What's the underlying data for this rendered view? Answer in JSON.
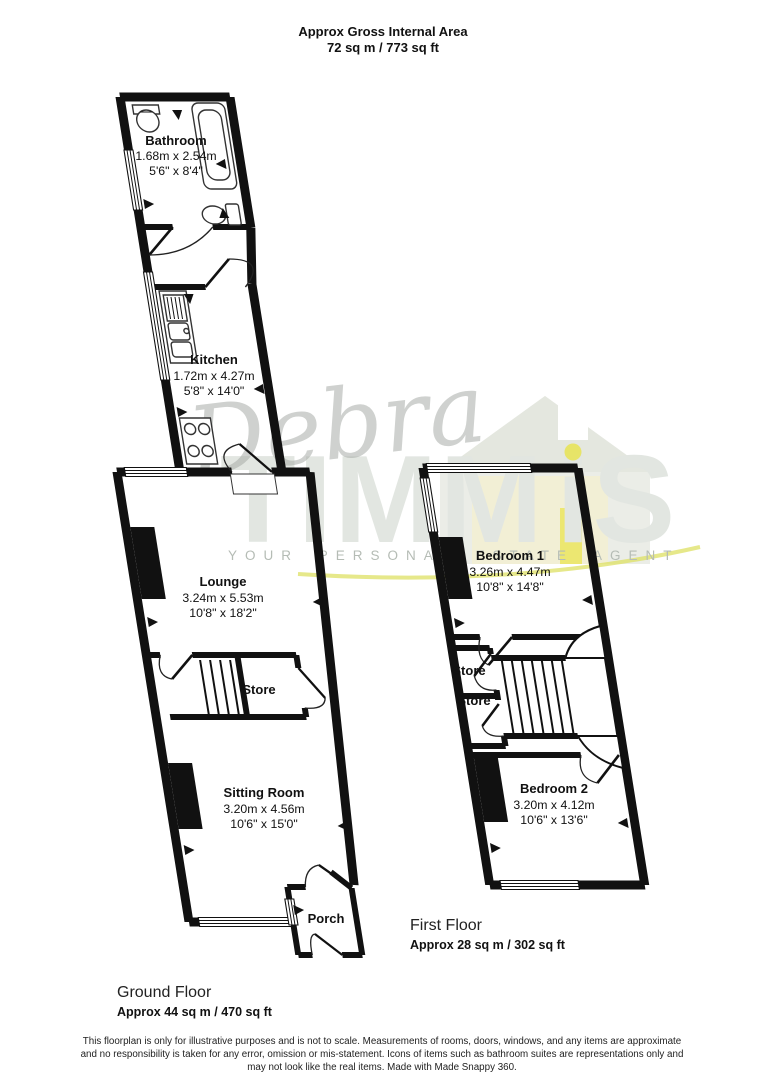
{
  "header": {
    "title_line1": "Approx Gross Internal Area",
    "title_line2": "72 sq m / 773 sq ft"
  },
  "watermark": {
    "script": "Debra",
    "brand_part1": "TIMM",
    "brand_part2": "iS",
    "tagline": "YOUR PERSONAL ESTATE AGENT",
    "colors": {
      "brand_gray": "#e2e6e1",
      "tagline_gray": "#b5bcb5",
      "accent_yellow": "#e8e352",
      "swoosh_yellow": "#dde063"
    }
  },
  "ground_floor": {
    "label": "Ground Floor",
    "area": "Approx 44 sq m / 470 sq ft",
    "rooms": {
      "bathroom": {
        "name": "Bathroom",
        "dims_m": "1.68m x 2.54m",
        "dims_ft": "5'6\" x 8'4\""
      },
      "kitchen": {
        "name": "Kitchen",
        "dims_m": "1.72m x 4.27m",
        "dims_ft": "5'8\" x 14'0\""
      },
      "lounge": {
        "name": "Lounge",
        "dims_m": "3.24m x 5.53m",
        "dims_ft": "10'8\" x 18'2\""
      },
      "store": {
        "name": "Store"
      },
      "sitting_room": {
        "name": "Sitting Room",
        "dims_m": "3.20m x 4.56m",
        "dims_ft": "10'6\" x 15'0\""
      },
      "porch": {
        "name": "Porch"
      }
    }
  },
  "first_floor": {
    "label": "First Floor",
    "area": "Approx 28 sq m / 302 sq ft",
    "rooms": {
      "bedroom1": {
        "name": "Bedroom 1",
        "dims_m": "3.26m x 4.47m",
        "dims_ft": "10'8\" x 14'8\""
      },
      "store1": {
        "name": "Store"
      },
      "store2": {
        "name": "Store"
      },
      "bedroom2": {
        "name": "Bedroom 2",
        "dims_m": "3.20m x 4.12m",
        "dims_ft": "10'6\" x 13'6\""
      }
    }
  },
  "footer": {
    "line1": "This floorplan is only for illustrative purposes and is not to scale. Measurements of rooms, doors, windows, and any items are approximate",
    "line2": "and no responsibility is taken for any error, omission or mis-statement. Icons of items such as bathroom suites are representations only and",
    "line3": "may not look like the real items. Made with Made Snappy 360."
  }
}
